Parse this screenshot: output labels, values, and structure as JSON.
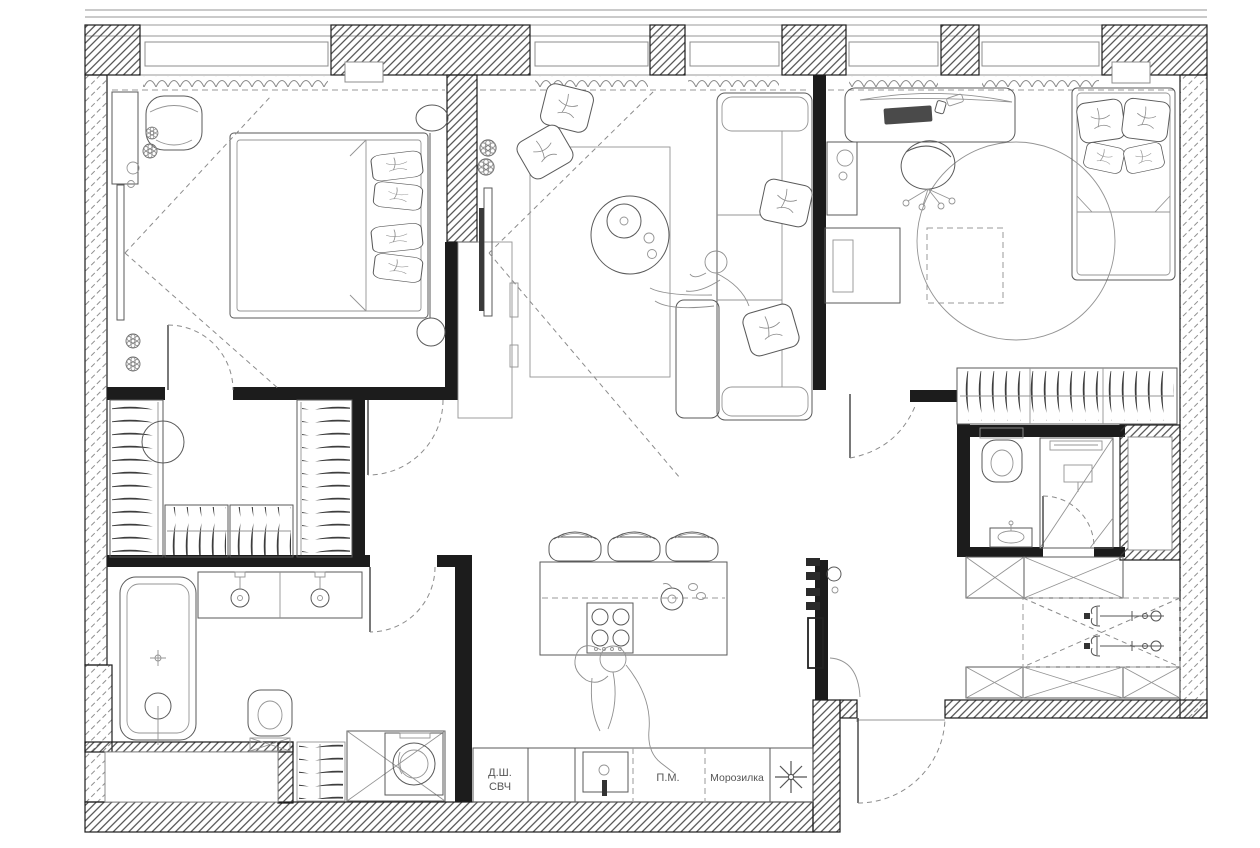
{
  "title": "apartment-floor-plan",
  "colors": {
    "ink": "#1c1c1c",
    "line": "#5a5a5a",
    "light": "#949494",
    "bg": "#ffffff"
  },
  "kitchen": {
    "labels": {
      "oven_microwave_l1": "Д.Ш.",
      "oven_microwave_l2": "СВЧ",
      "dishwasher": "П.М.",
      "freezer": "Морозилка"
    },
    "fridge_symbol": "snowflake-asterisk"
  }
}
